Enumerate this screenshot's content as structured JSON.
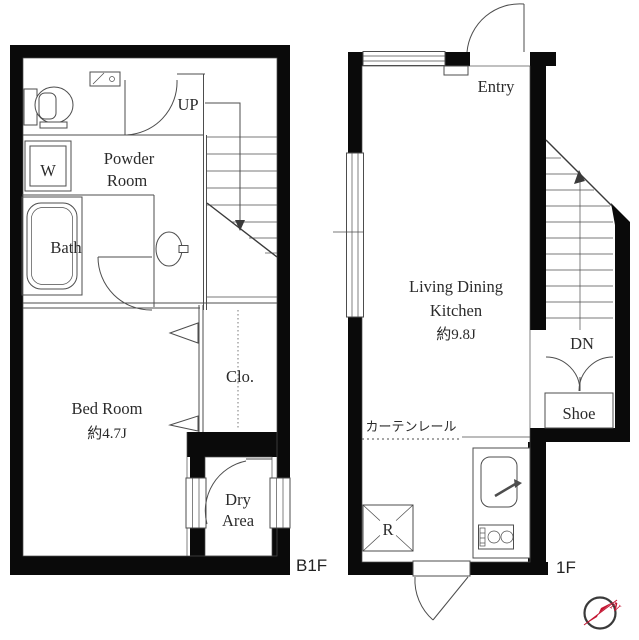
{
  "title": "Maisonette floor plan B1F / 1F",
  "floors": {
    "b1f": {
      "floor_label": "B1F",
      "up_label": "UP",
      "powder_room_line1": "Powder",
      "powder_room_line2": "Room",
      "washer_label": "W",
      "bath_label": "Bath",
      "bedroom_name": "Bed Room",
      "bedroom_size": "約4.7J",
      "closet_label": "Clo.",
      "dry_area_line1": "Dry",
      "dry_area_line2": "Area"
    },
    "f1": {
      "floor_label": "1F",
      "entry_label": "Entry",
      "ldk_line1": "Living Dining",
      "ldk_line2": "Kitchen",
      "ldk_size": "約9.8J",
      "down_label": "DN",
      "shoe_label": "Shoe",
      "curtain_rail_label": "カーテンレール",
      "refrigerator_label": "R"
    }
  },
  "compass": {
    "north_label": "N"
  },
  "colors": {
    "wall": "#0a0a0a",
    "line": "#4d4d4d",
    "text": "#2b2b2b",
    "compass_red": "#c41431",
    "background": "#ffffff"
  }
}
